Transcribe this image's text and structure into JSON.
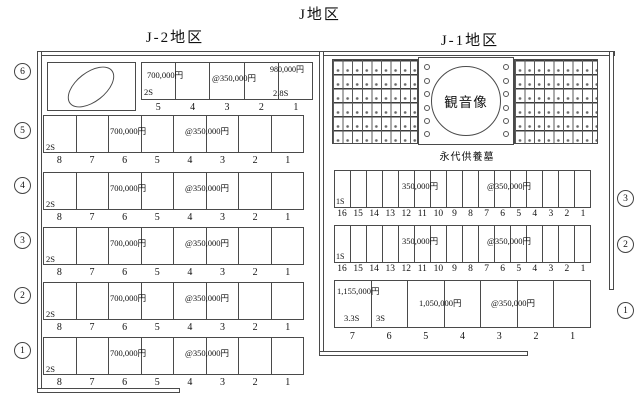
{
  "title": "J地区",
  "j2": {
    "heading": "J-2地区",
    "row6_label": "6",
    "row6": {
      "price_a": "700,000円",
      "size_a": "2S",
      "price_b": "@350,000円",
      "price_c": "980,000円",
      "size_c": "2.8S",
      "numbers": [
        "5",
        "4",
        "3",
        "2",
        "1"
      ]
    },
    "rows": [
      {
        "label": "5"
      },
      {
        "label": "4"
      },
      {
        "label": "3"
      },
      {
        "label": "2"
      },
      {
        "label": "1"
      }
    ],
    "standard": {
      "size": "2S",
      "price_a": "700,000円",
      "price_b": "@350,000円",
      "numbers": [
        "8",
        "7",
        "6",
        "5",
        "4",
        "3",
        "2",
        "1"
      ]
    }
  },
  "j1": {
    "heading": "J-1地区",
    "statue": "観音像",
    "memorial": "永代供養墓",
    "mid_labels": [
      "3",
      "2"
    ],
    "mid": {
      "size": "1S",
      "price_a": "350,000円",
      "price_b": "@350,000円",
      "numbers": [
        "16",
        "15",
        "14",
        "13",
        "12",
        "11",
        "10",
        "9",
        "8",
        "7",
        "6",
        "5",
        "4",
        "3",
        "2",
        "1"
      ]
    },
    "bottom": {
      "label": "1",
      "price_a": "1,155,000円",
      "size_a": "3.3S",
      "size_b": "3S",
      "price_b": "1,050,000円",
      "price_c": "@350,000円",
      "numbers": [
        "7",
        "6",
        "5",
        "4",
        "3",
        "2",
        "1"
      ]
    }
  }
}
